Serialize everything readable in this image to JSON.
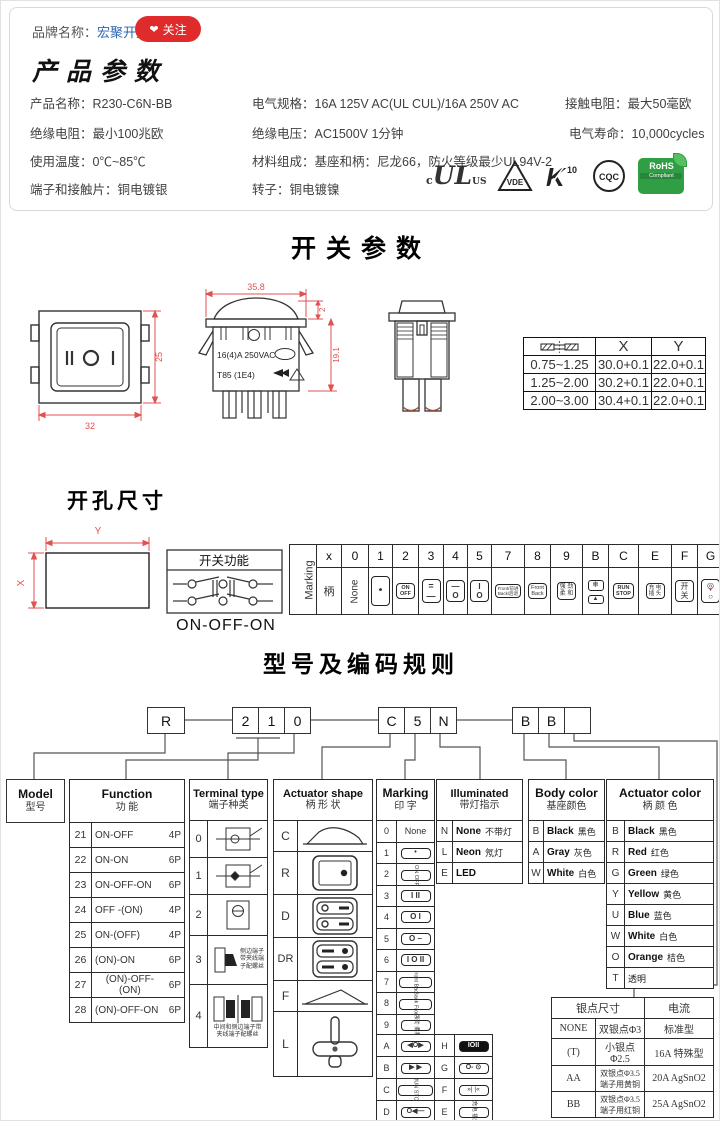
{
  "brand": {
    "label": "品牌名称：",
    "name": "宏聚开关",
    "follow": "关注",
    "heart": "❤"
  },
  "product": {
    "title": "产品参数",
    "col1": [
      "产品名称：R230-C6N-BB",
      "绝缘电阻：最小100兆欧",
      "使用温度：0℃~85℃",
      "端子和接触片：铜电镀银"
    ],
    "col2": [
      "电气规格：16A 125V AC(UL CUL)/16A 250V AC",
      "绝缘电压：AC1500V 1分钟",
      "材料组成：基座和柄：尼龙66，防火等级最少UL94V-2",
      "转子：铜电镀镍"
    ],
    "col3": [
      "接触电阻：最大50毫欧",
      "电气寿命：10,000cycles"
    ],
    "certs": {
      "ul_c": "c",
      "ul": "UL",
      "ul_us": "US",
      "vde": "VDE",
      "k10": "10",
      "k": "K",
      "cqc": "CQC",
      "rohs": "RoHS",
      "rohs2": "Compliant"
    }
  },
  "sw": {
    "title": "开关参数",
    "front": {
      "w": "32",
      "h": "25"
    },
    "side": {
      "w": "35.8",
      "h": "19.1",
      "cap": "2",
      "l1": "16(4)A 250VAC",
      "l2": "T85  (1E4)"
    },
    "xy": {
      "x": "X",
      "y": "Y",
      "rows": [
        [
          "0.75~1.25",
          "30.0+0.1",
          "22.0+0.1"
        ],
        [
          "1.25~2.00",
          "30.2+0.1",
          "22.0+0.1"
        ],
        [
          "2.00~3.00",
          "30.4+0.1",
          "22.0+0.1"
        ]
      ]
    }
  },
  "cutout": {
    "title": "开孔尺寸",
    "x": "X",
    "y": "Y"
  },
  "fb": {
    "title": "开关功能",
    "label": "ON-OFF-ON"
  },
  "ms": {
    "title": "Marking",
    "handle": "柄",
    "none": "None",
    "codes": [
      "x",
      "0",
      "1",
      "2",
      "3",
      "4",
      "5",
      "7",
      "8",
      "9",
      "B",
      "C",
      "E",
      "F",
      "G"
    ],
    "cols": [
      {
        "t": "•",
        "b": ""
      },
      {
        "t": "ON",
        "b": "OFF"
      },
      {
        "t": "=",
        "b": "—"
      },
      {
        "t": "—",
        "b": "O"
      },
      {
        "t": "I",
        "b": "O"
      },
      {
        "t": "Front/前进",
        "b": "Back/后退"
      },
      {
        "t": "Front",
        "b": "Back"
      },
      {
        "t": "强 劲",
        "b": "柔 和"
      },
      {
        "t": "❄",
        "b": "▲"
      },
      {
        "t": "RUN",
        "b": "STOP"
      },
      {
        "t": "充 电",
        "b": "插 头"
      },
      {
        "t": "开",
        "b": "关"
      },
      {
        "t": "◎",
        "dot": "•",
        "b": "○"
      }
    ]
  },
  "coding": {
    "title": "型号及编码规则",
    "b1": [
      "R"
    ],
    "b2": [
      "2",
      "1",
      "0"
    ],
    "b3": [
      "C",
      "5",
      "N"
    ],
    "b4": [
      "B",
      "B",
      ""
    ],
    "model": {
      "en": "Model",
      "cn": "型号"
    },
    "fn": {
      "en": "Function",
      "cn": "功  能",
      "rows": [
        {
          "c": "21",
          "f": "ON-OFF",
          "p": "4P"
        },
        {
          "c": "22",
          "f": "ON-ON",
          "p": "6P"
        },
        {
          "c": "23",
          "f": "ON-OFF-ON",
          "p": "6P"
        },
        {
          "c": "24",
          "f": "OFF -(ON)",
          "p": "4P"
        },
        {
          "c": "25",
          "f": "ON-(OFF)",
          "p": "4P"
        },
        {
          "c": "26",
          "f": "(ON)-ON",
          "p": "6P"
        },
        {
          "c": "27",
          "f": "(ON)-OFF-(ON)",
          "p": "6P"
        },
        {
          "c": "28",
          "f": "(ON)-OFF-ON",
          "p": "6P"
        }
      ]
    },
    "tt": {
      "en": "Terminal type",
      "cn": "端子种类",
      "codes": [
        "0",
        "1",
        "2",
        "3",
        "4"
      ],
      "n3": [
        "侧边端子",
        "带夹线端",
        "子配螺丝"
      ],
      "n4": [
        "中间和侧边端子带",
        "夹线端子配螺丝"
      ]
    },
    "as": {
      "en": "Actuator shape",
      "cn": "柄 形 状",
      "codes": [
        "C",
        "R",
        "D",
        "DR",
        "F",
        "L"
      ]
    },
    "mk": {
      "en": "Marking",
      "cn": "印  字",
      "rows": [
        {
          "c": "0",
          "t": "None"
        },
        {
          "c": "1",
          "t": "•"
        },
        {
          "c": "2",
          "t": "ON OFF"
        },
        {
          "c": "3",
          "t": "I  II"
        },
        {
          "c": "4",
          "t": "O  I"
        },
        {
          "c": "5",
          "t": "O  –"
        },
        {
          "c": "6",
          "t": "I O II"
        },
        {
          "c": "7",
          "t": "Front Back"
        },
        {
          "c": "8",
          "t": "Back Front"
        },
        {
          "c": "9",
          "t": "强劲 柔和"
        }
      ],
      "rows2": [
        {
          "c1": "A",
          "t1": "◀O▶",
          "c2": "H",
          "t2": "IOII"
        },
        {
          "c1": "B",
          "t1": "▶ ▶",
          "c2": "G",
          "t2": "O- ⊙"
        },
        {
          "c1": "C",
          "t1": "RUN STOP",
          "c2": "F",
          "t2": "»|  |«"
        },
        {
          "c1": "D",
          "t1": "O◀—",
          "c2": "E",
          "t2": "充电 插头"
        }
      ]
    },
    "il": {
      "en": "Illuminated",
      "cn": "带灯指示",
      "rows": [
        {
          "c": "N",
          "en": "None",
          "cn": "不带灯"
        },
        {
          "c": "L",
          "en": "Neon",
          "cn": "氖灯"
        },
        {
          "c": "E",
          "en": "LED",
          "cn": ""
        }
      ]
    },
    "bc": {
      "en": "Body color",
      "cn": "基座颜色",
      "rows": [
        {
          "c": "B",
          "en": "Black",
          "cn": "黑色"
        },
        {
          "c": "A",
          "en": "Gray",
          "cn": "灰色"
        },
        {
          "c": "W",
          "en": "White",
          "cn": "白色"
        }
      ]
    },
    "ac": {
      "en": "Actuator color",
      "cn": "柄 颜 色",
      "rows": [
        {
          "c": "B",
          "en": "Black",
          "cn": "黑色"
        },
        {
          "c": "R",
          "en": "Red",
          "cn": "红色"
        },
        {
          "c": "G",
          "en": "Green",
          "cn": "绿色"
        },
        {
          "c": "Y",
          "en": "Yellow",
          "cn": "黄色"
        },
        {
          "c": "U",
          "en": "Blue",
          "cn": "蓝色"
        },
        {
          "c": "W",
          "en": "White",
          "cn": "白色"
        },
        {
          "c": "O",
          "en": "Orange",
          "cn": "桔色"
        },
        {
          "c": "T",
          "en": "透明",
          "cn": ""
        }
      ]
    },
    "sv": {
      "h1": "银点尺寸",
      "h2": "电流",
      "rows": [
        {
          "c": "NONE",
          "d1": "双银点Φ3",
          "d2": "",
          "a": "标准型"
        },
        {
          "c": "(T)",
          "d1": "小银点Φ2.5",
          "d2": "",
          "a": "16A 特殊型"
        },
        {
          "c": "AA",
          "d1": "双银点Φ3.5",
          "d2": "端子用黄铜",
          "a": "20A AgSnO2"
        },
        {
          "c": "BB",
          "d1": "双银点Φ3.5",
          "d2": "端子用红铜",
          "a": "25A AgSnO2"
        }
      ]
    }
  }
}
